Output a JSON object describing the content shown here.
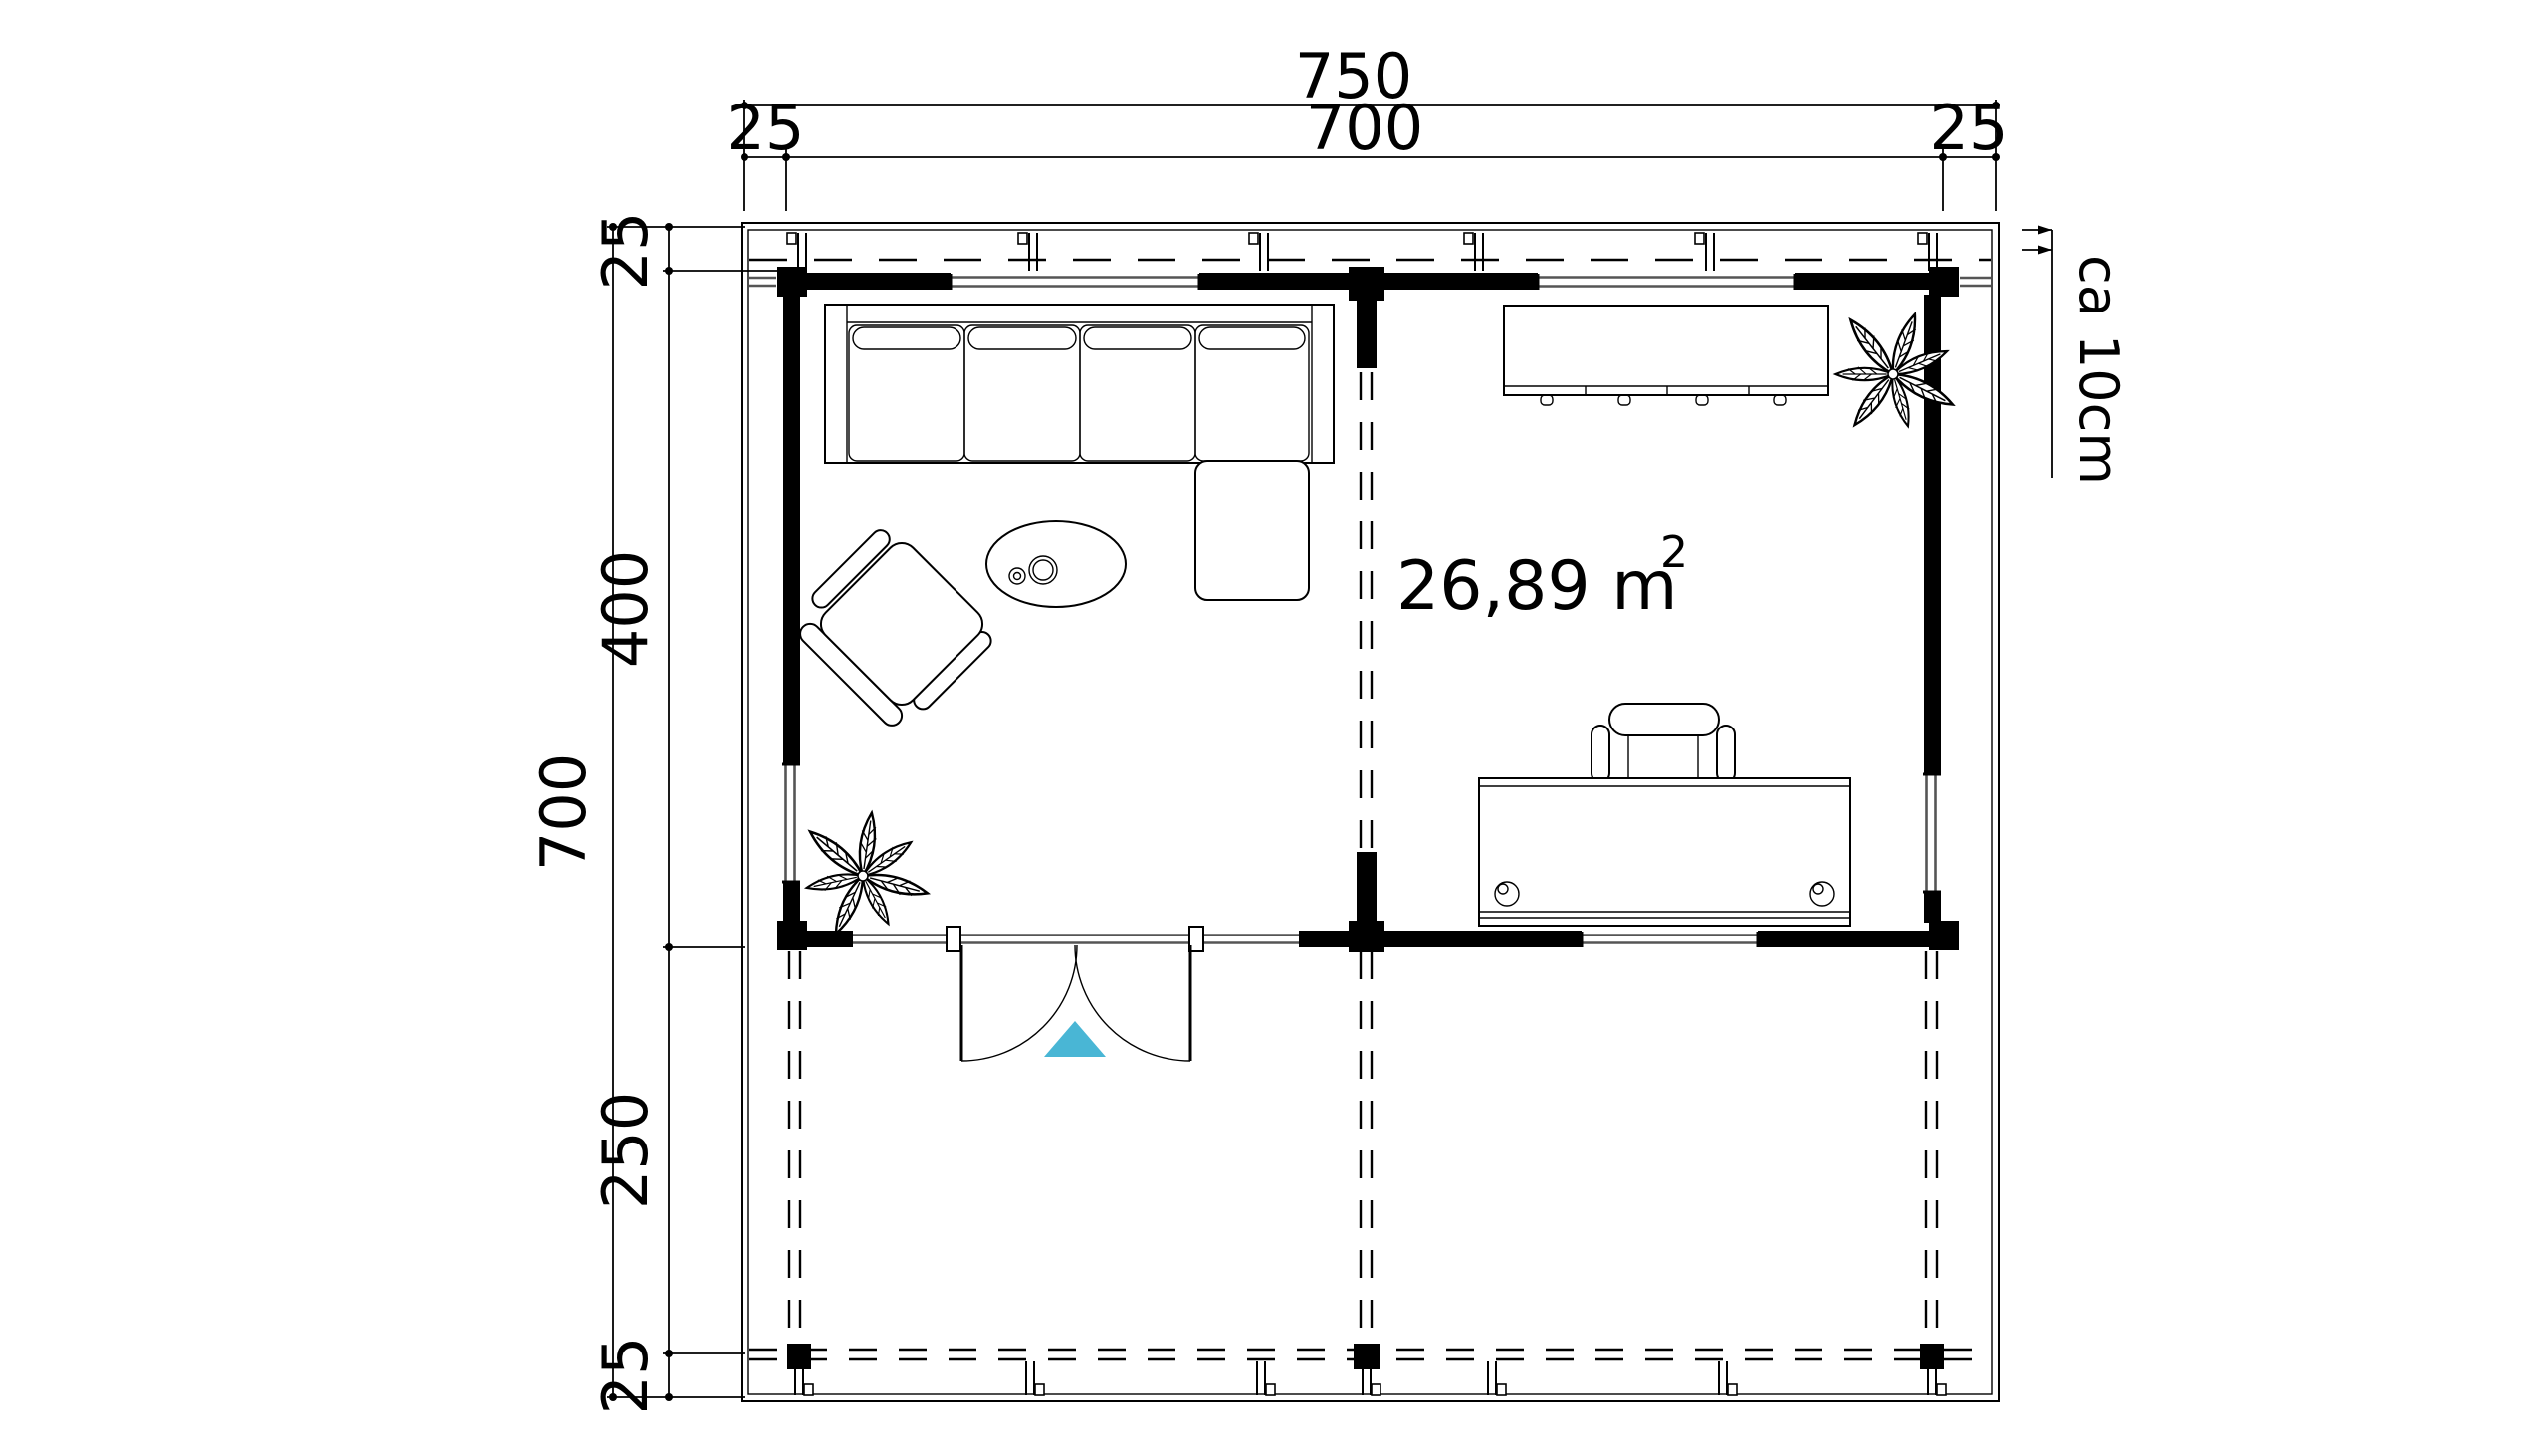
{
  "plan": {
    "area": {
      "value": "26,89 m",
      "exponent": "2"
    },
    "overhang_note": "ca 10cm",
    "dimensions": {
      "top_total": "750",
      "top_left": "25",
      "top_center": "700",
      "top_right": "25",
      "left_total": "700",
      "left_top": "25",
      "left_middle": "400",
      "left_lower": "250",
      "left_bottom": "25"
    },
    "colors": {
      "door_marker": "#49b6d5",
      "lines": "#000000",
      "glazing": "#555555"
    },
    "furniture": {
      "sofa": "corner-sofa",
      "coffee_table": "oval-coffee-table",
      "armchair": "armchair",
      "desk": "desk",
      "desk_chair": "office-chair",
      "sideboard": "sideboard",
      "plant_top_right": "potted-plant",
      "plant_bottom_left": "potted-plant",
      "door": "double-swing-door"
    }
  }
}
